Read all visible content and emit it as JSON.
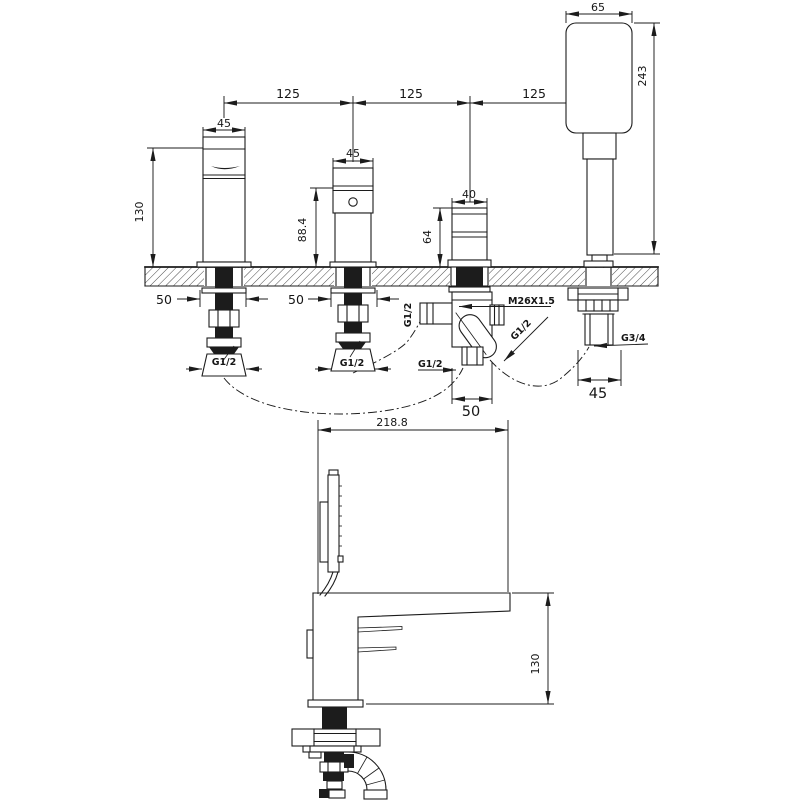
{
  "colors": {
    "line": "#1c1c1c",
    "background": "#ffffff"
  },
  "front_view": {
    "pitch_dims": [
      "125",
      "125",
      "125"
    ],
    "spout": {
      "width": "45",
      "height": "130",
      "hole": "50",
      "thread": "G1/2"
    },
    "valve": {
      "width": "45",
      "height": "88.4",
      "hole": "50",
      "thread": "G1/2"
    },
    "diverter": {
      "width": "40",
      "height": "64",
      "body_width": "50",
      "side_thread": "G1/2",
      "top_thread": "M26X1.5",
      "outlet_thread": "G1/2",
      "bottom_thread": "G1/2"
    },
    "handshower": {
      "width": "65",
      "height": "243",
      "body_width": "45",
      "thread": "G3/4"
    }
  },
  "side_view": {
    "depth": "218.8",
    "height": "130"
  }
}
